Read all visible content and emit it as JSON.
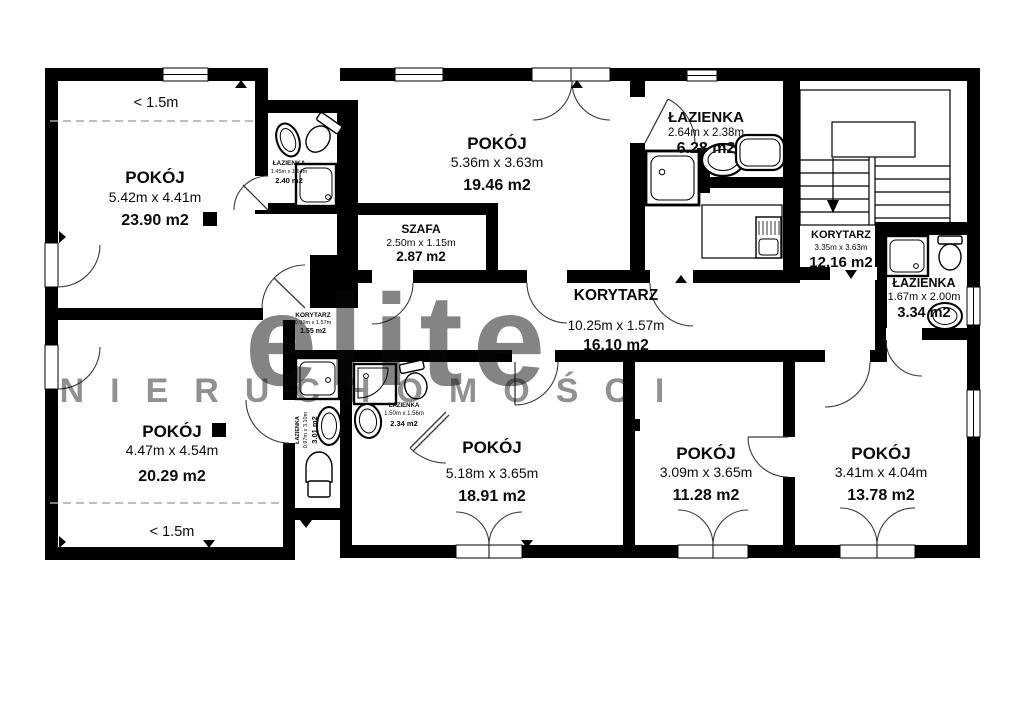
{
  "plan": {
    "watermark": {
      "brand": "elite",
      "subtitle": "NIERUCHOMOŚCI"
    },
    "rooms": {
      "pokoj_top_left": {
        "name": "POKÓJ",
        "dims": "5.42m x 4.41m",
        "area": "23.90 m2",
        "note": "< 1.5m"
      },
      "lazienka_top_left": {
        "name": "ŁAZIENKA",
        "dims": "1.45m x 1.64m",
        "area": "2.40 m2"
      },
      "pokoj_top_mid": {
        "name": "POKÓJ",
        "dims": "5.36m x 3.63m",
        "area": "19.46 m2"
      },
      "szafa": {
        "name": "SZAFA",
        "dims": "2.50m x 1.15m",
        "area": "2.87 m2"
      },
      "lazienka_top": {
        "name": "ŁAZIENKA",
        "dims": "2.64m x 2.38m",
        "area": "6.28 m2"
      },
      "korytarz_stairs": {
        "name": "KORYTARZ",
        "dims": "3.35m x 3.63m",
        "area": "12.16 m2"
      },
      "lazienka_right": {
        "name": "ŁAZIENKA",
        "dims": "1.67m x 2.00m",
        "area": "3.34 m2"
      },
      "korytarz_main": {
        "name": "KORYTARZ",
        "dims": "10.25m x 1.57m",
        "area": "16.10 m2"
      },
      "korytarz_small": {
        "name": "KORYTARZ",
        "dims": "0.99m x 1.57m",
        "area": "1.55 m2"
      },
      "pokoj_bottom_left": {
        "name": "POKÓJ",
        "dims": "4.47m x 4.54m",
        "area": "20.29 m2",
        "note": "< 1.5m"
      },
      "lazienka_narrow": {
        "name": "ŁAZIENKA",
        "dims": "0.97m x 3.10m",
        "area": "3.01 m2"
      },
      "lazienka_small": {
        "name": "ŁAZIENKA",
        "dims": "1.50m x 1.56m",
        "area": "2.34 m2"
      },
      "pokoj_bottom_mid": {
        "name": "POKÓJ",
        "dims": "5.18m x 3.65m",
        "area": "18.91 m2"
      },
      "pokoj_bottom_r2": {
        "name": "POKÓJ",
        "dims": "3.09m x 3.65m",
        "area": "11.28 m2"
      },
      "pokoj_bottom_right": {
        "name": "POKÓJ",
        "dims": "3.41m x 4.04m",
        "area": "13.78 m2"
      }
    }
  }
}
